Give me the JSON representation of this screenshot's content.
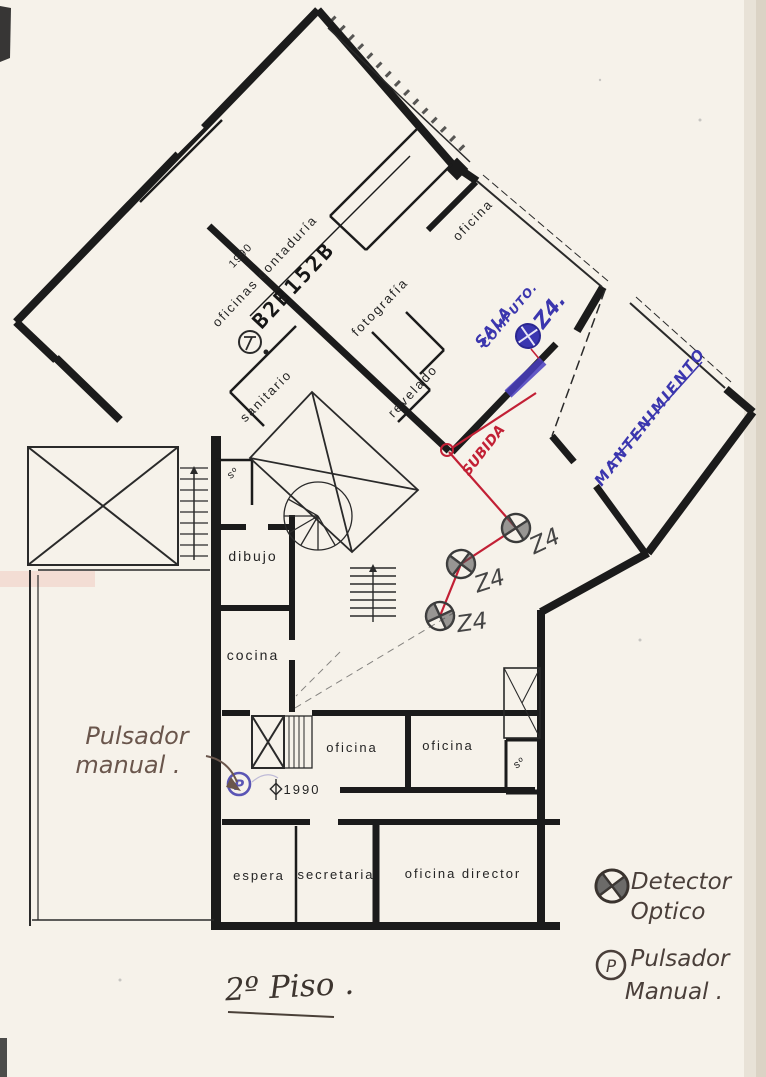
{
  "document": {
    "floor_title": "2º Piso .",
    "stamp": "B2B152B"
  },
  "plan_labels": {
    "oficinas_contaduria": "oficinas contaduría",
    "year_top": "1990",
    "fotografia": "fotografía",
    "oficina_top": "oficina",
    "sanitario": "sanitario",
    "revelado": "revelado",
    "s_upper": "sº",
    "dibujo": "dibujo",
    "cocina": "cocina",
    "oficina_left": "oficina",
    "oficina_right": "oficina",
    "s_lower": "sº",
    "espera": "espera",
    "secretaria": "secretaria",
    "oficina_director": "oficina  director",
    "year_bottom": "1990"
  },
  "ink_blue": {
    "sala_computo_line1": "SALA",
    "sala_computo_line2": "COMPUTO.",
    "zone_computo": "Z4.",
    "mantenimiento": "MANTENIMIENTO",
    "p_mark": "P"
  },
  "ink_red": {
    "subida": "SUBIDA"
  },
  "pencil_notes": {
    "pulsador_note_line1": "Pulsador",
    "pulsador_note_line2": "manual .",
    "zone1": "Z4",
    "zone2": "Z4",
    "zone3": "Z4"
  },
  "legend": {
    "detector_line1": "Detector",
    "detector_line2": "Optico",
    "pulsador_line1": "Pulsador",
    "pulsador_line2": "Manual .",
    "p_symbol": "P"
  },
  "colors": {
    "wall": "#1b1b1b",
    "red_circuit": "#c22035",
    "blue_ink": "#3b36ae",
    "pencil": "#6a564c",
    "paper": "#f6f2ea"
  }
}
